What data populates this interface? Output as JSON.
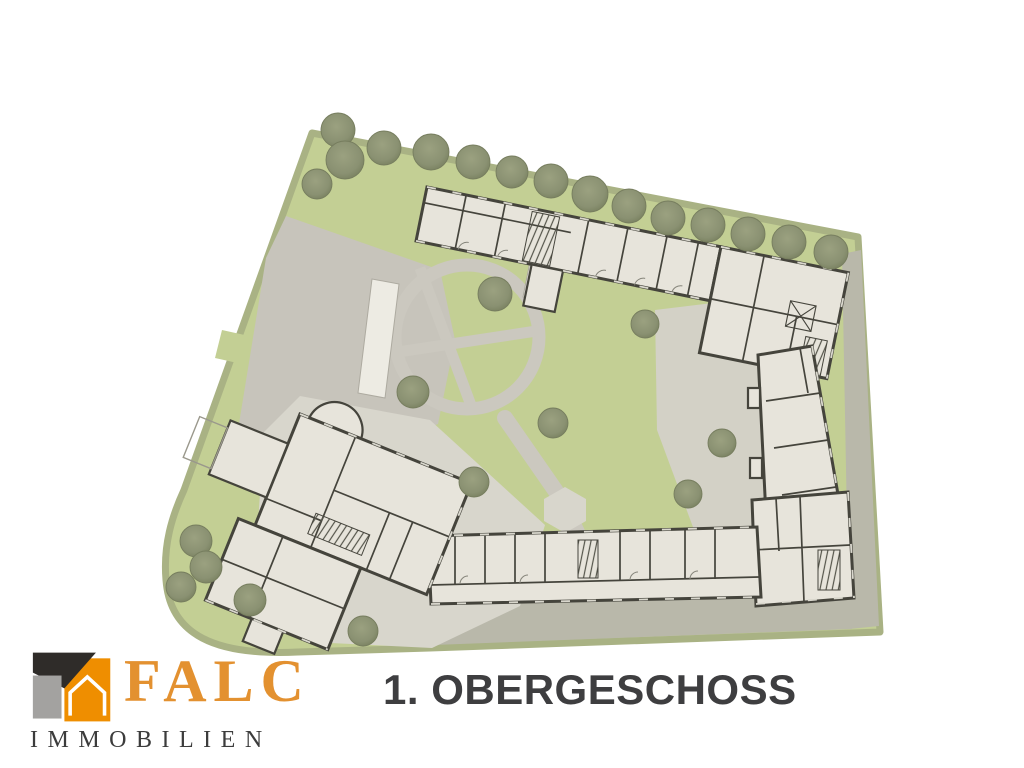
{
  "caption": {
    "title": "1. OBERGESCHOSS"
  },
  "branding": {
    "name": "FALC",
    "subtitle": "IMMOBILIEN",
    "colors": {
      "orange": "#e39130",
      "dark": "#3c3c3c",
      "icon_dark": "#2f2c29",
      "icon_gray": "#a3a2a0",
      "icon_orange": "#ef8e00"
    }
  },
  "plan": {
    "description": "site-plan-first-floor",
    "colors": {
      "lawn": "#c3cf94",
      "lawn_edge": "#a9b284",
      "paving": "#c7c4bb",
      "paving_light": "#d8d6cc",
      "plaza": "#d3d1c6",
      "band": "#b9b8aa",
      "path_gray": "#cbc8bf",
      "room": "#e7e4db",
      "wall": "#45443c",
      "win": "#d9d7cd",
      "white_bldg": "#edebe3",
      "tree_edge": "#767d5e",
      "caption": "#3e3e40"
    },
    "trees": {
      "border": [
        [
          338,
          130,
          17
        ],
        [
          345,
          160,
          19
        ],
        [
          317,
          184,
          15
        ],
        [
          384,
          148,
          17
        ],
        [
          431,
          152,
          18
        ],
        [
          473,
          162,
          17
        ],
        [
          512,
          172,
          16
        ],
        [
          551,
          181,
          17
        ],
        [
          590,
          194,
          18
        ],
        [
          629,
          206,
          17
        ],
        [
          668,
          218,
          17
        ],
        [
          708,
          225,
          17
        ],
        [
          748,
          234,
          17
        ],
        [
          789,
          242,
          17
        ],
        [
          831,
          252,
          17
        ]
      ],
      "courtyard": [
        [
          495,
          294,
          17
        ],
        [
          413,
          392,
          16
        ],
        [
          553,
          423,
          15
        ],
        [
          474,
          482,
          15
        ],
        [
          645,
          324,
          14
        ],
        [
          722,
          443,
          14
        ],
        [
          688,
          494,
          14
        ]
      ],
      "cluster": [
        [
          196,
          541,
          16
        ],
        [
          206,
          567,
          16
        ],
        [
          181,
          587,
          15
        ],
        [
          250,
          600,
          16
        ],
        [
          363,
          631,
          15
        ]
      ]
    }
  }
}
